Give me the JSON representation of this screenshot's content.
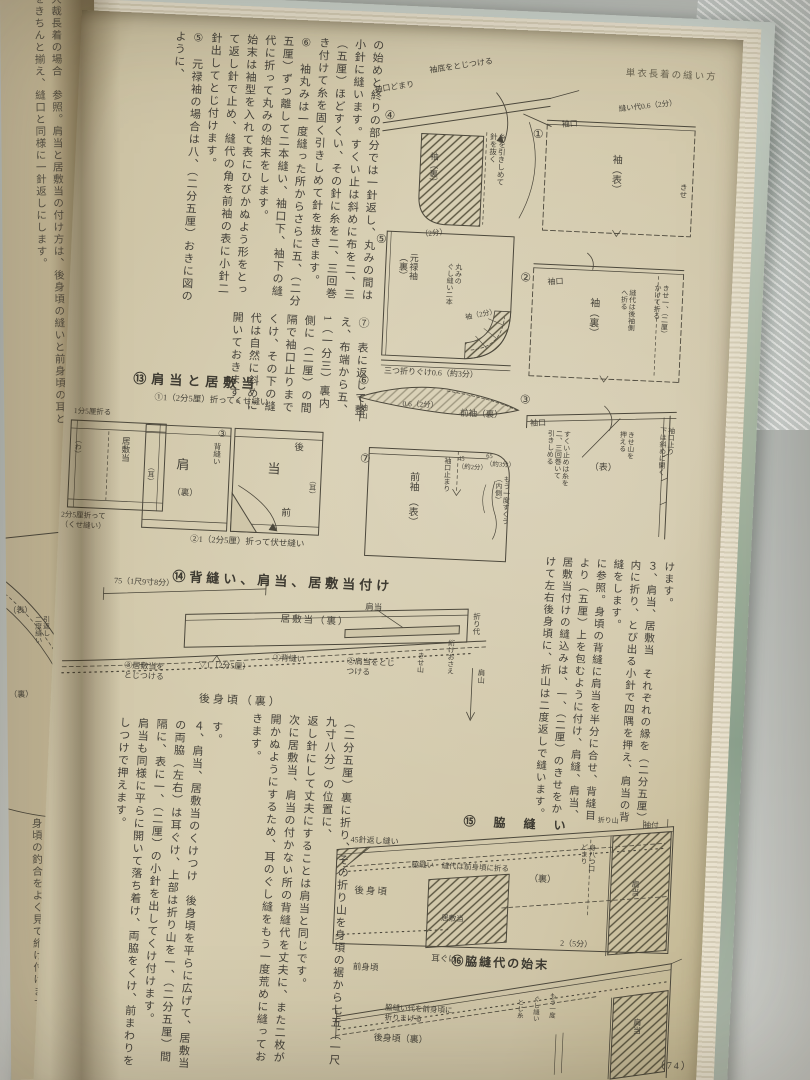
{
  "colors": {
    "paper": "#d6cdb0",
    "ink": "#46433a",
    "cover_green": "#8fa491",
    "metal": "#dde4e1"
  },
  "book": {
    "page_number": "（74）"
  },
  "left_page": {
    "top_text": "大裁長着の場合　参照。肩当と居敷当の付け方は、後身頃の縫いと前身頃の耳とをきちんと揃え、縫口と同様に一針返しにします。",
    "bottom_text": "このように、二枚いっしょに押え、たいへん手軽に三つ折りぐけと同じに仕上がります。衿と身頃の釣合をよく見て絎け付けます。",
    "diagram_labels": [
      {
        "t": "（表）",
        "x": 2,
        "y": 606,
        "s": 8
      },
      {
        "t": "引返し\n二度縫い",
        "x": 28,
        "y": 616,
        "v": 1,
        "s": 7
      },
      {
        "t": "（裏）",
        "x": 2,
        "y": 690,
        "s": 8
      }
    ]
  },
  "right_page": {
    "running_head": "単衣長着の縫い方",
    "paragraphs": {
      "top_band": "の始めと終りの部分では一針返し、丸みの間は小針に縫います。すくい止は斜めに布を二、三（五厘）ほどすくい、その針に糸を二、三回巻き付けて糸を固く引きしめて針を抜きます。\n⑥　袖丸みは一度縫った所からさらに五、（二分五厘）ずつ離して二本縫い、袖口下、袖下の縫代に折って丸みの始末をします。\n始末は袖型を入れて表にひびかぬよう形をとって返し針で止め、縫代の角を前袖の表に小針二針出してとじ付けます。\n⑤　元禄袖の場合は八、（二分五厘）おきに図のように、",
      "top_band_lower": "⑦　表に返して整え、布端から五、1（一分三）裏内側に（二厘）の間隔で袖口止りまでくけ、その下の縫代は自然に斜めに開いておきます。",
      "mid_right": "けます。\n３、肩当、居敷当　それぞれの縁を（二分五厘）内に折り、とび出る小針で四隅を押え、肩当の背縫をします。\nに参照。身頃の背縫に肩当を半分に合せ、背縫目より（五厘）上を包むように付け、肩縫、肩当、居敷当付けの縫込みは、一、（二厘）のきせをかけて左右後身頃に、折山は二度返しで縫います。",
      "bottom_center": "（二分五厘）裏に折り、その折り山を身頃の裾から七五（一尺九寸八分）の位置に、\n返し針にして丈夫にすることは肩当と同じです。\n次に居敷当、肩当の付かない所の背縫代を丈夫に、また二枚が開かぬようにするため、耳のぐし縫をもう一度荒めに縫っておきます。",
      "bottom_left": "す。\n４、肩当、居敷当のくけつけ　後身頃を平らに広げて、居敷当の両脇（左右）は耳ぐけ、上部は折り山を一、（二分五厘）間隔に、表に一、（二厘）の小針を出してくけ付けます。\n肩当も同様に平らに開いて落ち着け、両脇をくけ、前まわりをしつけで押えます。"
    },
    "diagram_labels": [
      {
        "t": "④",
        "x": 307,
        "y": 84,
        "s": 12
      },
      {
        "t": "袖底をとじつける",
        "x": 349,
        "y": 40,
        "s": 8,
        "r": -11
      },
      {
        "t": "袖口どまり",
        "x": 295,
        "y": 62,
        "s": 8,
        "r": -11
      },
      {
        "t": "糸を引きしめて\n針を抜く",
        "x": 412,
        "y": 104,
        "v": 1,
        "s": 7.5
      },
      {
        "t": "袖（裏）",
        "x": 353,
        "y": 126,
        "v": 1,
        "s": 8.5
      },
      {
        "t": "（2分）",
        "x": 348,
        "y": 204,
        "s": 7.5,
        "r": -8
      },
      {
        "t": "①",
        "x": 456,
        "y": 96,
        "s": 12
      },
      {
        "t": "袖口",
        "x": 484,
        "y": 88,
        "s": 8,
        "r": -6
      },
      {
        "t": "袖（表）",
        "x": 534,
        "y": 120,
        "v": 1,
        "s": 10
      },
      {
        "t": "縫い代0.6（2分）",
        "x": 540,
        "y": 70,
        "s": 7.5,
        "r": -9
      },
      {
        "t": "きせ",
        "x": 604,
        "y": 146,
        "v": 1,
        "s": 7.5
      },
      {
        "t": "②",
        "x": 450,
        "y": 240,
        "s": 12
      },
      {
        "t": "袖口",
        "x": 477,
        "y": 246,
        "s": 8,
        "r": -5
      },
      {
        "t": "袖（裏）",
        "x": 518,
        "y": 264,
        "v": 1,
        "s": 10
      },
      {
        "t": "縫代は後袖側\nへ折る",
        "x": 551,
        "y": 254,
        "v": 1,
        "s": 7
      },
      {
        "t": "きせ一、（二厘）\nかけて折る",
        "x": 584,
        "y": 248,
        "v": 1,
        "s": 7
      },
      {
        "t": "③",
        "x": 455,
        "y": 362,
        "s": 12
      },
      {
        "t": "袖口",
        "x": 466,
        "y": 388,
        "s": 8,
        "r": -4
      },
      {
        "t": "（表）",
        "x": 528,
        "y": 428,
        "s": 9
      },
      {
        "t": "すくい止めは糸を\n二、三回巻いて\n引きしめる",
        "x": 484,
        "y": 398,
        "v": 1,
        "s": 7
      },
      {
        "t": "きせ山を\n押える",
        "x": 556,
        "y": 396,
        "v": 1,
        "s": 7
      },
      {
        "t": "袖口止り\n下は斜めに開く",
        "x": 596,
        "y": 390,
        "v": 1,
        "s": 7
      },
      {
        "t": "⑤",
        "x": 304,
        "y": 208,
        "s": 12
      },
      {
        "t": "元禄袖\n（裏）",
        "x": 327,
        "y": 228,
        "v": 1,
        "s": 9
      },
      {
        "t": "丸みの\nぐし縫い二本",
        "x": 376,
        "y": 236,
        "v": 1,
        "s": 7
      },
      {
        "t": "袖（2分）",
        "x": 396,
        "y": 286,
        "s": 7,
        "r": -14
      },
      {
        "t": "三つ折りぐけ0.6（約3分）",
        "x": 318,
        "y": 342,
        "s": 8
      },
      {
        "t": "⑥",
        "x": 293,
        "y": 350,
        "s": 12
      },
      {
        "t": "袖山",
        "x": 295,
        "y": 380,
        "v": 1,
        "s": 8
      },
      {
        "t": "0.6（2分）",
        "x": 338,
        "y": 374,
        "s": 7.5
      },
      {
        "t": "前袖（裏）",
        "x": 396,
        "y": 380,
        "s": 8.5
      },
      {
        "t": "⑦",
        "x": 298,
        "y": 428,
        "s": 12
      },
      {
        "t": "前袖　（表）",
        "x": 346,
        "y": 446,
        "v": 1,
        "s": 10
      },
      {
        "t": "袖口止まり",
        "x": 382,
        "y": 430,
        "v": 1,
        "s": 7
      },
      {
        "t": "45\n（約2分）",
        "x": 396,
        "y": 428,
        "s": 6.5
      },
      {
        "t": "65\n（約3分）",
        "x": 424,
        "y": 424,
        "s": 6.5
      },
      {
        "t": "もう一度すくう\n（内側）",
        "x": 434,
        "y": 446,
        "v": 1,
        "s": 7
      },
      {
        "t": "⑬肩当と居敷当",
        "x": 68,
        "y": 358,
        "s": 13,
        "b": 1,
        "ls": 5,
        "n": "section-heading-13"
      },
      {
        "t": "①1（2分5厘）折ってくせ縫い",
        "x": 90,
        "y": 378,
        "s": 8.5
      },
      {
        "t": "1分5厘折る",
        "x": 10,
        "y": 396,
        "s": 7.5
      },
      {
        "t": "（わ）",
        "x": 12,
        "y": 426,
        "v": 1,
        "s": 7
      },
      {
        "t": "居敷当",
        "x": 58,
        "y": 424,
        "v": 1,
        "s": 8.5
      },
      {
        "t": "2分5厘折って\n（くせ縫い）",
        "x": 2,
        "y": 500,
        "s": 7.5
      },
      {
        "t": "肩",
        "x": 115,
        "y": 442,
        "s": 13
      },
      {
        "t": "（裏）",
        "x": 112,
        "y": 472,
        "s": 8.5
      },
      {
        "t": "（耳）",
        "x": 86,
        "y": 450,
        "v": 1,
        "s": 7
      },
      {
        "t": "③",
        "x": 155,
        "y": 412,
        "s": 9.5
      },
      {
        "t": "背縫い",
        "x": 150,
        "y": 426,
        "v": 1,
        "s": 7.5
      },
      {
        "t": "当",
        "x": 206,
        "y": 442,
        "s": 13
      },
      {
        "t": "後",
        "x": 232,
        "y": 422,
        "s": 9.5
      },
      {
        "t": "前",
        "x": 222,
        "y": 488,
        "s": 9.5
      },
      {
        "t": "（耳）",
        "x": 248,
        "y": 456,
        "v": 1,
        "s": 7
      },
      {
        "t": "②1（2分5厘）折って伏せ縫い",
        "x": 132,
        "y": 518,
        "s": 8.5
      },
      {
        "t": "⑭背縫い、肩当、居敷当付け",
        "x": 116,
        "y": 554,
        "s": 13,
        "b": 1,
        "ls": 4,
        "n": "section-heading-14"
      },
      {
        "t": "75（1尺9寸8分）",
        "x": 58,
        "y": 564,
        "s": 8
      },
      {
        "t": "居敷当（裏）",
        "x": 226,
        "y": 594,
        "s": 9.5,
        "ls": 2
      },
      {
        "t": "折り代",
        "x": 417,
        "y": 584,
        "v": 1,
        "s": 7.5
      },
      {
        "t": "③居敷当を\nとじつける",
        "x": 72,
        "y": 648,
        "s": 8
      },
      {
        "t": "▽1（2分5厘）",
        "x": 146,
        "y": 644,
        "s": 8
      },
      {
        "t": "①背縫い",
        "x": 220,
        "y": 634,
        "s": 8
      },
      {
        "t": "肩当",
        "x": 310,
        "y": 578,
        "s": 8.5
      },
      {
        "t": "②肩当をとじ\nつける",
        "x": 294,
        "y": 634,
        "s": 8
      },
      {
        "t": "きせ山",
        "x": 364,
        "y": 626,
        "v": 1,
        "s": 7
      },
      {
        "t": "絎けおさえ",
        "x": 394,
        "y": 612,
        "v": 1,
        "s": 7
      },
      {
        "t": "肩山",
        "x": 424,
        "y": 640,
        "v": 1,
        "s": 7.5
      },
      {
        "t": "後身頃（裏）",
        "x": 148,
        "y": 676,
        "s": 11,
        "ls": 3
      },
      {
        "t": "⑮　脇　縫　い",
        "x": 418,
        "y": 786,
        "s": 12,
        "b": 1,
        "ls": 3,
        "n": "section-heading-15"
      },
      {
        "t": "45針返し縫い",
        "x": 306,
        "y": 812,
        "s": 8
      },
      {
        "t": "折り山",
        "x": 552,
        "y": 782,
        "s": 7
      },
      {
        "t": "袖付",
        "x": 598,
        "y": 784,
        "s": 7.5
      },
      {
        "t": "脇縫い　縫代は前身頃に折る",
        "x": 368,
        "y": 834,
        "s": 7.5
      },
      {
        "t": "後身頃",
        "x": 312,
        "y": 862,
        "s": 9.5,
        "ls": 2
      },
      {
        "t": "（裏）",
        "x": 486,
        "y": 842,
        "s": 9
      },
      {
        "t": "居敷当",
        "x": 400,
        "y": 886,
        "s": 7.5
      },
      {
        "t": "肩当",
        "x": 588,
        "y": 844,
        "v": 1,
        "s": 8
      },
      {
        "t": "身八つ口\nどまり",
        "x": 536,
        "y": 810,
        "v": 1,
        "s": 7
      },
      {
        "t": "⑯脇縫代の始末",
        "x": 412,
        "y": 926,
        "s": 12,
        "b": 1,
        "ls": 2,
        "n": "section-heading-16"
      },
      {
        "t": "前身頃",
        "x": 314,
        "y": 938,
        "s": 8.5
      },
      {
        "t": "耳ぐけ",
        "x": 392,
        "y": 926,
        "s": 8.5
      },
      {
        "t": "2（5分）",
        "x": 520,
        "y": 906,
        "s": 8
      },
      {
        "t": "脇縫い代を前身頃に\n折りまげる",
        "x": 348,
        "y": 978,
        "s": 7.5
      },
      {
        "t": "後身頃（裏）",
        "x": 338,
        "y": 1008,
        "s": 9
      },
      {
        "t": "とじ糸",
        "x": 478,
        "y": 968,
        "v": 1,
        "s": 6.5
      },
      {
        "t": "ぐし縫い",
        "x": 494,
        "y": 964,
        "v": 1,
        "s": 6.5
      },
      {
        "t": "もう一度",
        "x": 510,
        "y": 960,
        "v": 1,
        "s": 6.5
      },
      {
        "t": "肩当",
        "x": 596,
        "y": 982,
        "v": 1,
        "s": 8
      },
      {
        "t": "（74）",
        "x": 620,
        "y": 1022,
        "s": 10,
        "ls": 2,
        "n": "page-number"
      }
    ]
  }
}
